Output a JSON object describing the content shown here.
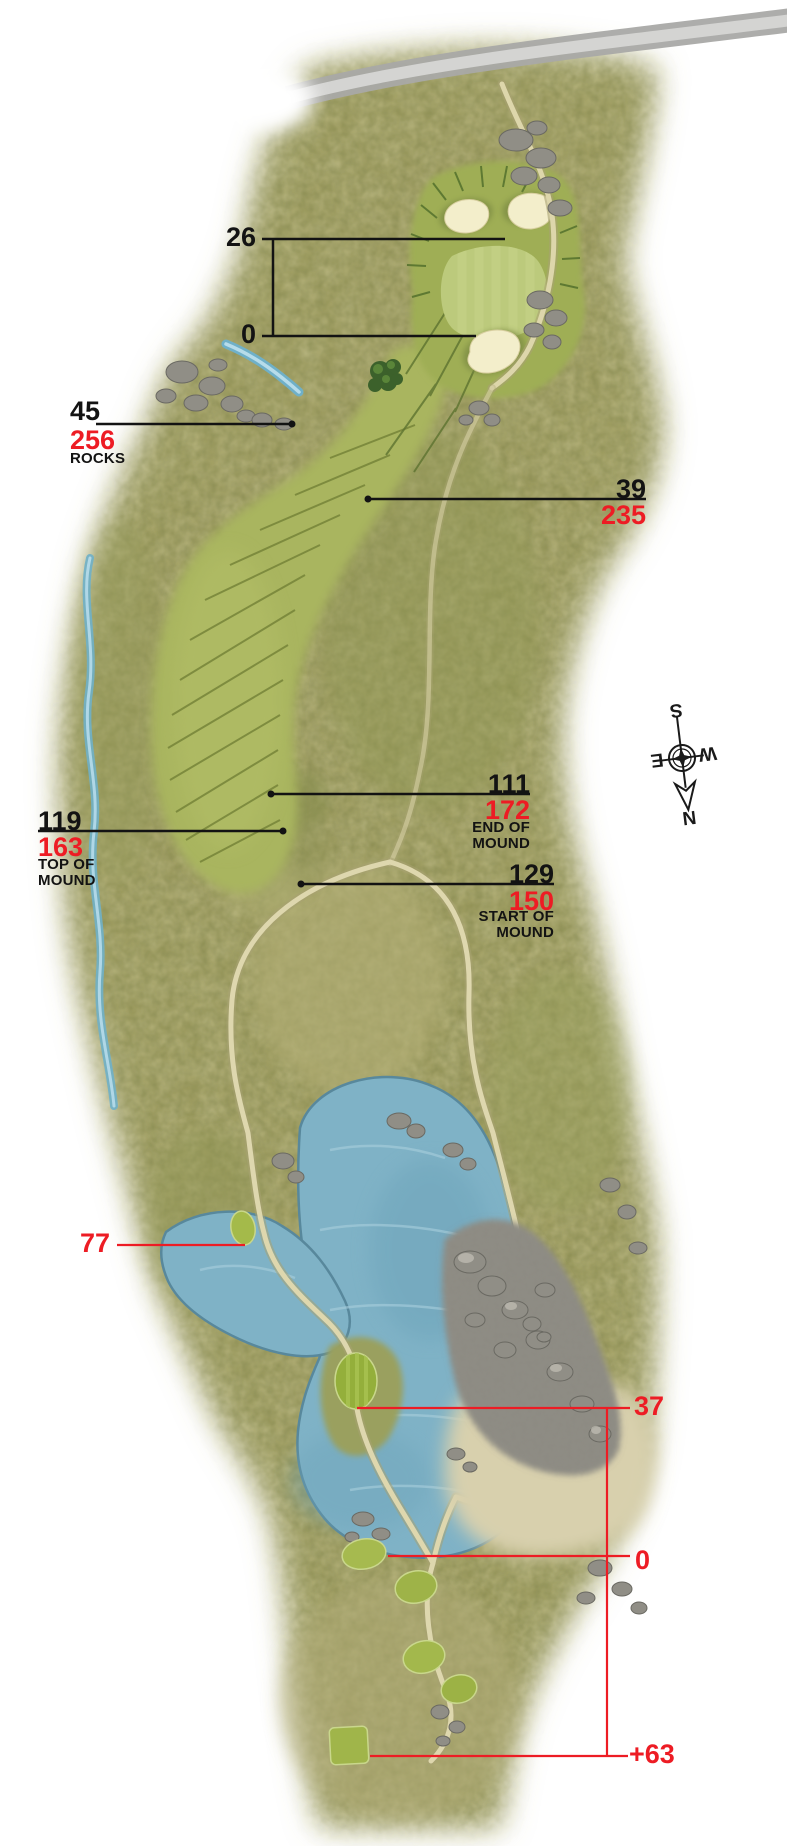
{
  "map": {
    "type": "golf-hole-yardage-map"
  },
  "colors": {
    "red_accent": "#ed1c24",
    "black_text": "#131313",
    "fairway_green": "#a9b55e",
    "rough_olive": "#a3a063",
    "water_blue": "#7fb2c6",
    "sand_cream": "#f3eecb",
    "path_tan": "#ddd6ab",
    "rock_gray": "#8f8d85"
  },
  "green_bracket": {
    "back": "26",
    "front": "0"
  },
  "callouts": {
    "rocks": {
      "black": "45",
      "red": "256",
      "caption": [
        "ROCKS"
      ]
    },
    "fairway": {
      "black": "39",
      "red": "235"
    },
    "end_of_mound": {
      "black": "111",
      "red": "172",
      "caption": [
        "END OF",
        "MOUND"
      ]
    },
    "top_of_mound": {
      "black": "119",
      "red": "163",
      "caption": [
        "TOP OF",
        "MOUND"
      ]
    },
    "start_of_mound": {
      "black": "129",
      "red": "150",
      "caption": [
        "START OF",
        "MOUND"
      ]
    }
  },
  "tees": {
    "forward": "77",
    "island": "37",
    "main": "0",
    "back": "+63"
  },
  "compass": {
    "n": "N",
    "s": "S",
    "e": "E",
    "w": "W"
  }
}
